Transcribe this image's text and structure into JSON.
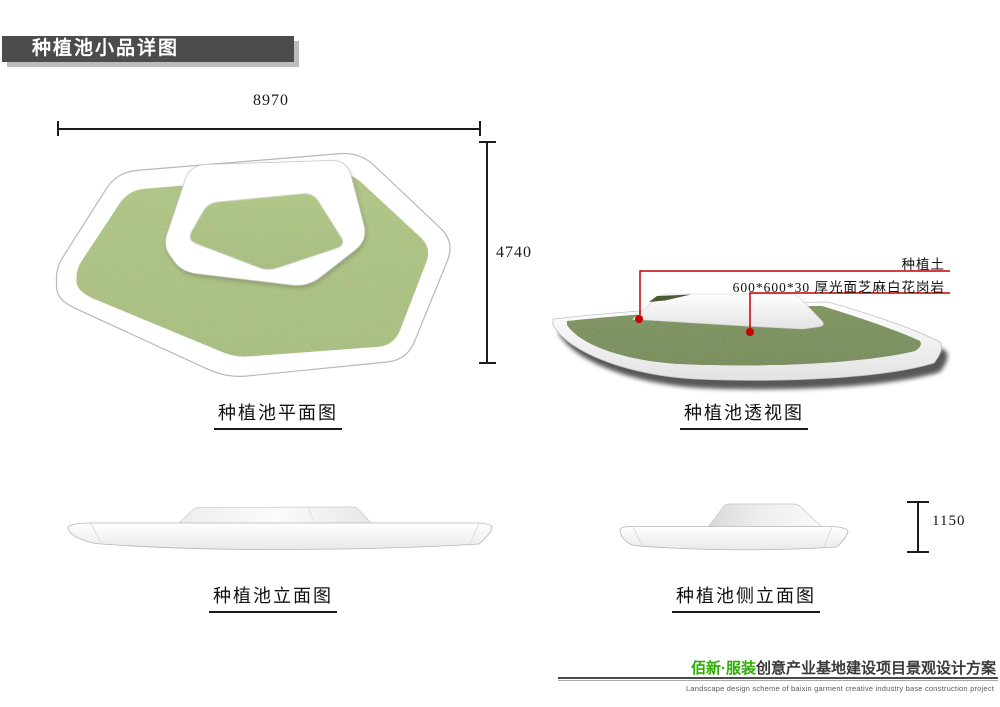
{
  "title_bar": {
    "text": "种植池小品详图"
  },
  "plan": {
    "caption": "种植池平面图",
    "dim_width": "8970",
    "dim_height": "4740"
  },
  "perspective": {
    "caption": "种植池透视图",
    "annotations": [
      {
        "label": "种植土"
      },
      {
        "label": "600*600*30 厚光面芝麻白花岗岩"
      }
    ]
  },
  "elevation": {
    "caption": "种植池立面图"
  },
  "side_elevation": {
    "caption": "种植池侧立面图",
    "dim_height": "1150"
  },
  "footer": {
    "brand": "佰新·服装",
    "title": "创意产业基地建设项目景观设计方案",
    "subtitle": "Landscape design scheme of baixin garment creative industry base construction project"
  },
  "colors": {
    "titlebar_gray": "#4c4c4c",
    "grass_green": "#8ea462",
    "soil_green": "#4c5a33",
    "leader_red": "#c40000",
    "brand_green": "#2fae06"
  }
}
